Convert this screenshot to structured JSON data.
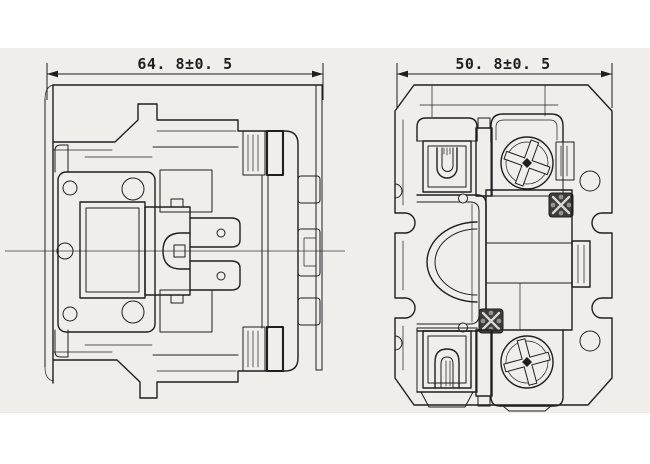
{
  "drawing": {
    "type": "technical-two-view-drawing",
    "subject": "contactor outline drawing",
    "front_view": {
      "dimension_label": "64. 8±0. 5"
    },
    "side_view": {
      "dimension_label": "50. 8±0. 5"
    }
  },
  "colors": {
    "page": "#ffffff",
    "canvas": "#efeeea",
    "line": "#1f1f1f",
    "centerline": "#3a3a3a",
    "screw_dark": "#3b3b3b"
  }
}
